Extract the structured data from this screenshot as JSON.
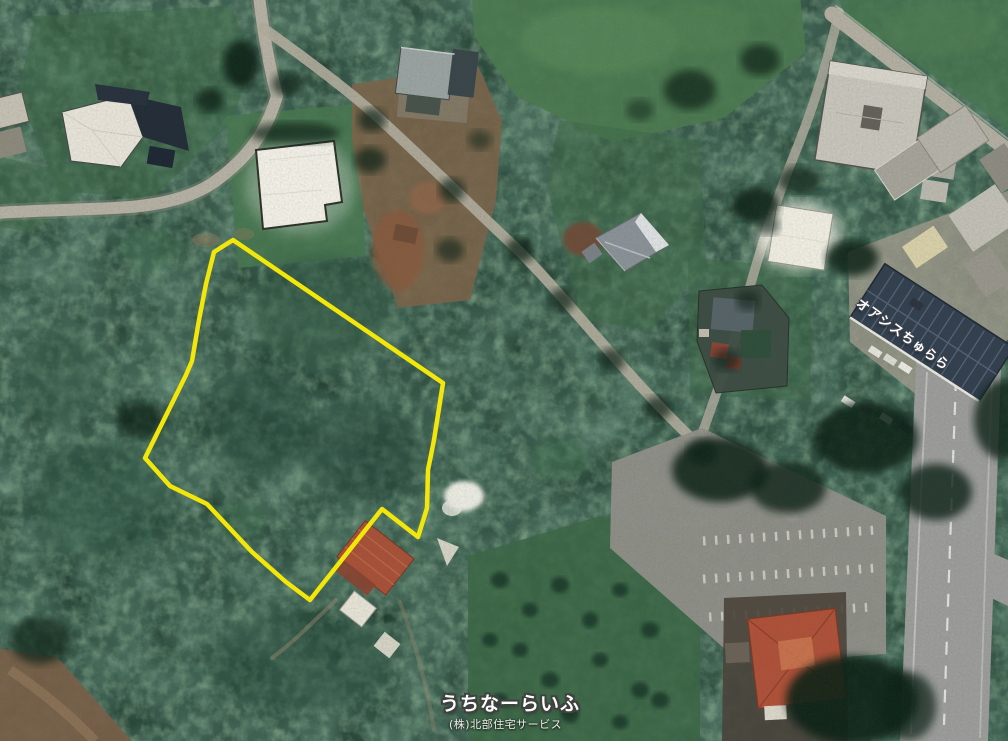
{
  "map": {
    "labels": {
      "building": "オアシスちゅらら",
      "watermark_title": "うちなーらいふ",
      "watermark_company": "(株)北部住宅サービス"
    },
    "colors": {
      "parcel_outline": "#f2e60a",
      "forest_base": "#1f3a2d",
      "watermark": "#ffffff"
    },
    "parcel": {
      "outline_points": "233,240 443,383 434,440 428,470 427,508 418,537 382,509 310,600 286,582 252,552 207,504 170,486 145,458 186,375 192,361 199,320 206,284 214,252"
    }
  }
}
